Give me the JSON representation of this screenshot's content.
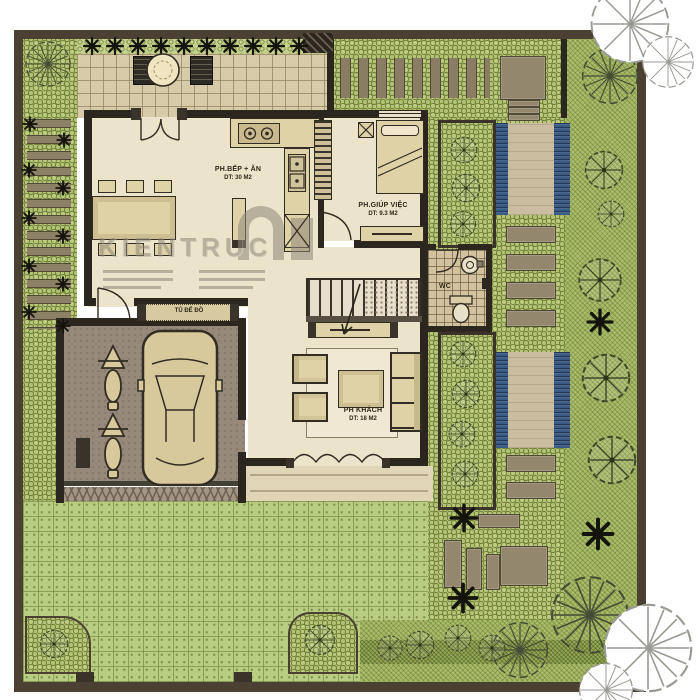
{
  "plan": {
    "watermark": "KIENTRUC",
    "rooms": {
      "kitchen_dining": {
        "name": "PH.BẾP + ĂN",
        "area": "DT: 30 M2"
      },
      "maid_room": {
        "name": "PH.GIÚP VIỆC",
        "area": "DT: 9.3 M2"
      },
      "wc": {
        "name": "WC"
      },
      "living_room": {
        "name": "PH KHÁCH",
        "area": "DT: 18 M2"
      },
      "storage": {
        "name": "TỦ ĐỂ ĐỒ"
      }
    },
    "colors": {
      "paper": "#ffffff",
      "frame": "#4a4132",
      "wall": "#2b261e",
      "lawn": "#b9cd82",
      "hedge": "#b6c478",
      "terrace_paving": "#d8cbaa",
      "interior_floor": "#ece3cb",
      "water": "#3a5c84",
      "garage_floor": "#97897a",
      "furniture": "#dfd2a6",
      "tree_stroke": "#3f4a28",
      "watermark_gray": "#8d8779"
    }
  }
}
